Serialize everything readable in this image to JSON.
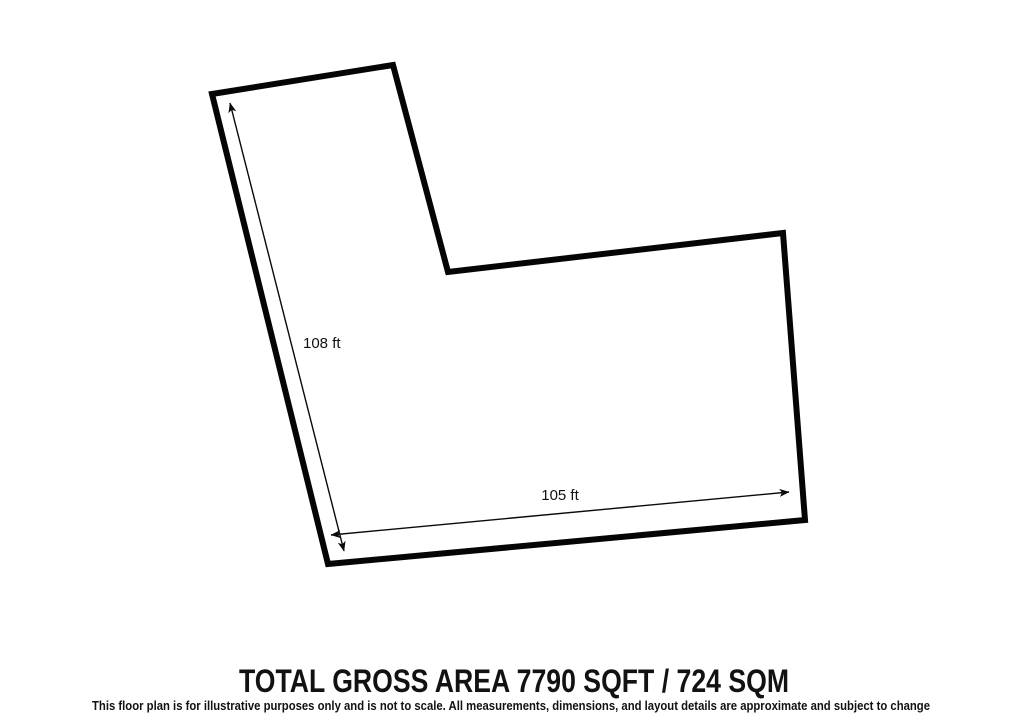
{
  "plan": {
    "vertical_dimension_label": "108 ft",
    "horizontal_dimension_label": "105 ft",
    "title": "TOTAL GROSS AREA 7790 SQFT / 724 SQM",
    "disclaimer": "This floor plan is for illustrative purposes only and is not to scale. All measurements, dimensions, and layout details are approximate and subject to change",
    "area_sqft": 7790,
    "area_sqm": 724,
    "colors": {
      "outline": "#050505",
      "background": "#ffffff",
      "text": "#121212"
    }
  }
}
